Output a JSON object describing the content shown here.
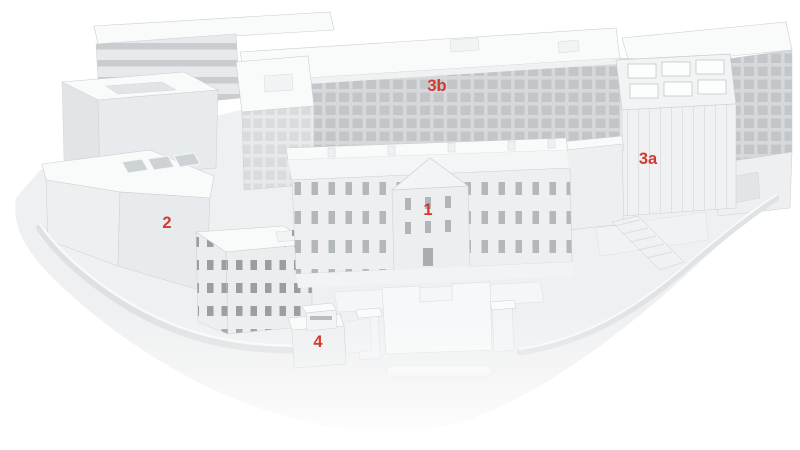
{
  "figure": {
    "type": "architectural-3d-site-model",
    "palette": {
      "background": "#ffffff",
      "ground": "#eff0f1",
      "roof": "#f9fafa",
      "face_light": "#edeff0",
      "face_mid": "#e8ebed",
      "face_dark": "#e2e5e7",
      "window_grid": "#c2c6c9",
      "window_dark": "#989ea2",
      "outline": "#cbcfd2",
      "label_color": "#d23a2e"
    },
    "labels": [
      {
        "id": "building-3b",
        "text": "3b",
        "x": 437,
        "y": 91
      },
      {
        "id": "building-3a",
        "text": "3a",
        "x": 648,
        "y": 164
      },
      {
        "id": "building-2",
        "text": "2",
        "x": 167,
        "y": 228
      },
      {
        "id": "building-1",
        "text": "1",
        "x": 428,
        "y": 215
      },
      {
        "id": "building-4",
        "text": "4",
        "x": 318,
        "y": 347
      }
    ]
  }
}
